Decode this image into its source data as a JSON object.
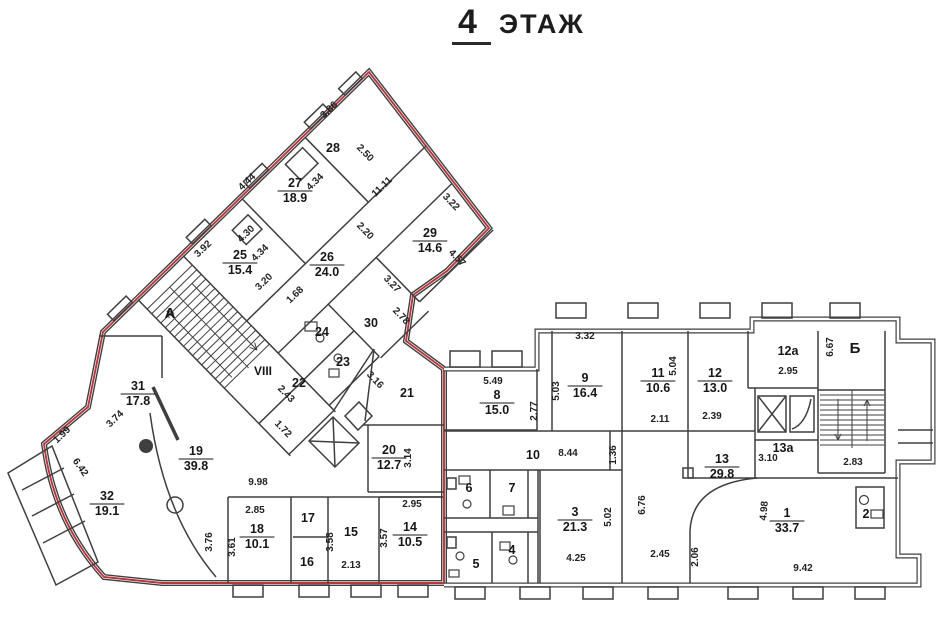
{
  "title": {
    "number": "4",
    "word": "ЭТАЖ"
  },
  "section": {
    "label": "VIII",
    "x": 263,
    "y": 375,
    "color": "#b5363c"
  },
  "accent_red": "#b5363c",
  "stair_letters": [
    {
      "label": "А",
      "x": 170,
      "y": 318
    },
    {
      "label": "Б",
      "x": 855,
      "y": 353
    }
  ],
  "rooms": [
    {
      "n": "28",
      "x": 333,
      "y": 147
    },
    {
      "n": "27",
      "area": "18.9",
      "x": 295,
      "y": 183
    },
    {
      "n": "25",
      "area": "15.4",
      "x": 240,
      "y": 255
    },
    {
      "n": "26",
      "area": "24.0",
      "x": 327,
      "y": 257
    },
    {
      "n": "29",
      "area": "14.6",
      "x": 430,
      "y": 233
    },
    {
      "n": "30",
      "x": 371,
      "y": 322
    },
    {
      "n": "24",
      "x": 322,
      "y": 331
    },
    {
      "n": "23",
      "x": 343,
      "y": 361
    },
    {
      "n": "22",
      "x": 299,
      "y": 382
    },
    {
      "n": "21",
      "x": 407,
      "y": 392
    },
    {
      "n": "31",
      "area": "17.8",
      "x": 138,
      "y": 386
    },
    {
      "n": "19",
      "area": "39.8",
      "x": 196,
      "y": 451
    },
    {
      "n": "32",
      "area": "19.1",
      "x": 107,
      "y": 496
    },
    {
      "n": "20",
      "area": "12.7",
      "x": 389,
      "y": 450
    },
    {
      "n": "18",
      "area": "10.1",
      "x": 257,
      "y": 529
    },
    {
      "n": "17",
      "x": 308,
      "y": 517
    },
    {
      "n": "16",
      "x": 307,
      "y": 561
    },
    {
      "n": "15",
      "x": 351,
      "y": 531
    },
    {
      "n": "14",
      "area": "10.5",
      "x": 410,
      "y": 527
    },
    {
      "n": "8",
      "area": "15.0",
      "x": 497,
      "y": 395
    },
    {
      "n": "9",
      "area": "16.4",
      "x": 585,
      "y": 378
    },
    {
      "n": "11",
      "area": "10.6",
      "x": 658,
      "y": 373
    },
    {
      "n": "12",
      "area": "13.0",
      "x": 715,
      "y": 373
    },
    {
      "n": "12а",
      "x": 788,
      "y": 350
    },
    {
      "n": "13а",
      "x": 783,
      "y": 447
    },
    {
      "n": "13",
      "area": "29.8",
      "x": 722,
      "y": 459
    },
    {
      "n": "10",
      "x": 533,
      "y": 454
    },
    {
      "n": "6",
      "x": 469,
      "y": 487
    },
    {
      "n": "7",
      "x": 512,
      "y": 487
    },
    {
      "n": "5",
      "x": 476,
      "y": 563
    },
    {
      "n": "4",
      "x": 512,
      "y": 549
    },
    {
      "n": "3",
      "area": "21.3",
      "x": 575,
      "y": 512
    },
    {
      "n": "1",
      "area": "33.7",
      "x": 787,
      "y": 513
    },
    {
      "n": "2",
      "x": 866,
      "y": 513
    }
  ],
  "dims": [
    {
      "v": "3.86",
      "x": 331,
      "y": 112,
      "r": -44
    },
    {
      "v": "2.50",
      "x": 363,
      "y": 155,
      "r": 46
    },
    {
      "v": "4.44",
      "x": 249,
      "y": 184,
      "r": -44
    },
    {
      "v": "4.34",
      "x": 317,
      "y": 184,
      "r": -44
    },
    {
      "v": "4.30",
      "x": 248,
      "y": 236,
      "r": -44
    },
    {
      "v": "3.92",
      "x": 205,
      "y": 251,
      "r": -44
    },
    {
      "v": "4.34",
      "x": 262,
      "y": 255,
      "r": -44
    },
    {
      "v": "3.20",
      "x": 266,
      "y": 284,
      "r": -44
    },
    {
      "v": "11.11",
      "x": 384,
      "y": 189,
      "r": -44
    },
    {
      "v": "2.20",
      "x": 363,
      "y": 233,
      "r": 46
    },
    {
      "v": "3.22",
      "x": 449,
      "y": 204,
      "r": 46
    },
    {
      "v": "4.57",
      "x": 455,
      "y": 260,
      "r": 46
    },
    {
      "v": "3.27",
      "x": 390,
      "y": 286,
      "r": 46
    },
    {
      "v": "1.68",
      "x": 297,
      "y": 297,
      "r": -44
    },
    {
      "v": "2.78",
      "x": 399,
      "y": 318,
      "r": 46
    },
    {
      "v": "3.16",
      "x": 373,
      "y": 382,
      "r": 46
    },
    {
      "v": "2.43",
      "x": 284,
      "y": 396,
      "r": 46
    },
    {
      "v": "1.72",
      "x": 281,
      "y": 431,
      "r": 46
    },
    {
      "v": "3.74",
      "x": 117,
      "y": 421,
      "r": -44
    },
    {
      "v": "1.99",
      "x": 64,
      "y": 437,
      "r": -44
    },
    {
      "v": "6.42",
      "x": 78,
      "y": 469,
      "r": 55
    },
    {
      "v": "3.14",
      "x": 411,
      "y": 458,
      "r": -90
    },
    {
      "v": "2.95",
      "x": 412,
      "y": 507,
      "r": 0
    },
    {
      "v": "9.98",
      "x": 258,
      "y": 485,
      "r": 0
    },
    {
      "v": "2.85",
      "x": 255,
      "y": 513,
      "r": 0
    },
    {
      "v": "3.76",
      "x": 212,
      "y": 542,
      "r": -90
    },
    {
      "v": "3.61",
      "x": 235,
      "y": 547,
      "r": -90
    },
    {
      "v": "3.58",
      "x": 333,
      "y": 542,
      "r": -90
    },
    {
      "v": "2.13",
      "x": 351,
      "y": 568,
      "r": 0
    },
    {
      "v": "3.57",
      "x": 387,
      "y": 538,
      "r": -90
    },
    {
      "v": "5.49",
      "x": 493,
      "y": 384,
      "r": 0
    },
    {
      "v": "2.77",
      "x": 537,
      "y": 411,
      "r": -90
    },
    {
      "v": "3.32",
      "x": 585,
      "y": 339,
      "r": 0
    },
    {
      "v": "5.03",
      "x": 559,
      "y": 391,
      "r": -90
    },
    {
      "v": "5.04",
      "x": 676,
      "y": 366,
      "r": -90
    },
    {
      "v": "2.11",
      "x": 660,
      "y": 422,
      "r": 0
    },
    {
      "v": "2.39",
      "x": 712,
      "y": 419,
      "r": 0
    },
    {
      "v": "2.95",
      "x": 788,
      "y": 374,
      "r": 0
    },
    {
      "v": "6.67",
      "x": 833,
      "y": 347,
      "r": -90
    },
    {
      "v": "2.83",
      "x": 853,
      "y": 465,
      "r": 0
    },
    {
      "v": "3.10",
      "x": 768,
      "y": 461,
      "r": 0
    },
    {
      "v": "8.44",
      "x": 568,
      "y": 456,
      "r": 0
    },
    {
      "v": "1.36",
      "x": 616,
      "y": 455,
      "r": -90
    },
    {
      "v": "5.02",
      "x": 611,
      "y": 517,
      "r": -90
    },
    {
      "v": "6.76",
      "x": 645,
      "y": 505,
      "r": -90
    },
    {
      "v": "4.25",
      "x": 576,
      "y": 561,
      "r": 0
    },
    {
      "v": "2.45",
      "x": 660,
      "y": 557,
      "r": 0
    },
    {
      "v": "2.06",
      "x": 698,
      "y": 557,
      "r": -90
    },
    {
      "v": "4.98",
      "x": 767,
      "y": 511,
      "r": -85
    },
    {
      "v": "9.42",
      "x": 803,
      "y": 571,
      "r": 0
    }
  ]
}
